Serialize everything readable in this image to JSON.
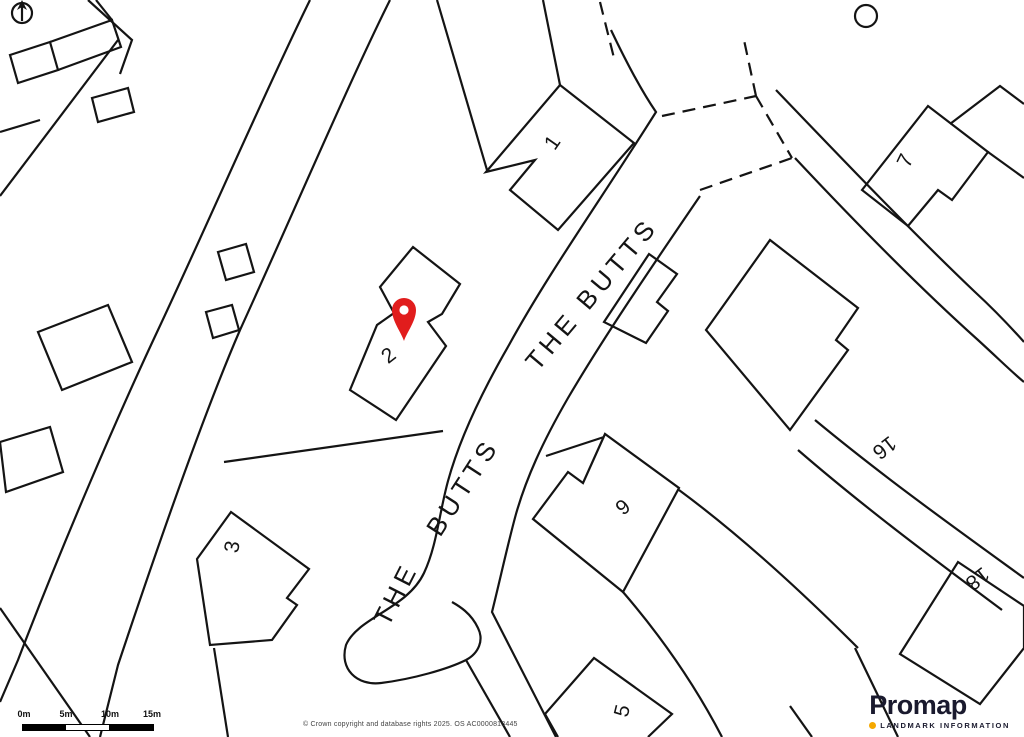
{
  "map": {
    "street_labels": [
      {
        "text": "THE BUTTS"
      },
      {
        "text": "THE"
      },
      {
        "text": "BUTTS"
      }
    ],
    "plot_numbers": [
      {
        "text": "1"
      },
      {
        "text": "2"
      },
      {
        "text": "3"
      },
      {
        "text": "5"
      },
      {
        "text": "6"
      },
      {
        "text": "7"
      },
      {
        "text": "16"
      },
      {
        "text": "18"
      }
    ],
    "line_color": "#141414",
    "marker_color": "#e11d1d",
    "icons": {
      "north_arrow": "compass-north-arrow",
      "marker": "location-pin"
    }
  },
  "scale_bar": {
    "labels": [
      "0m",
      "5m",
      "10m",
      "15m"
    ]
  },
  "attribution": {
    "text": "© Crown copyright and database rights 2025. OS AC0000813445"
  },
  "logo": {
    "brand": "Promap",
    "tagline": "LANDMARK INFORMATION",
    "accent_color": "#f5a800",
    "text_color": "#1a1a2e"
  }
}
